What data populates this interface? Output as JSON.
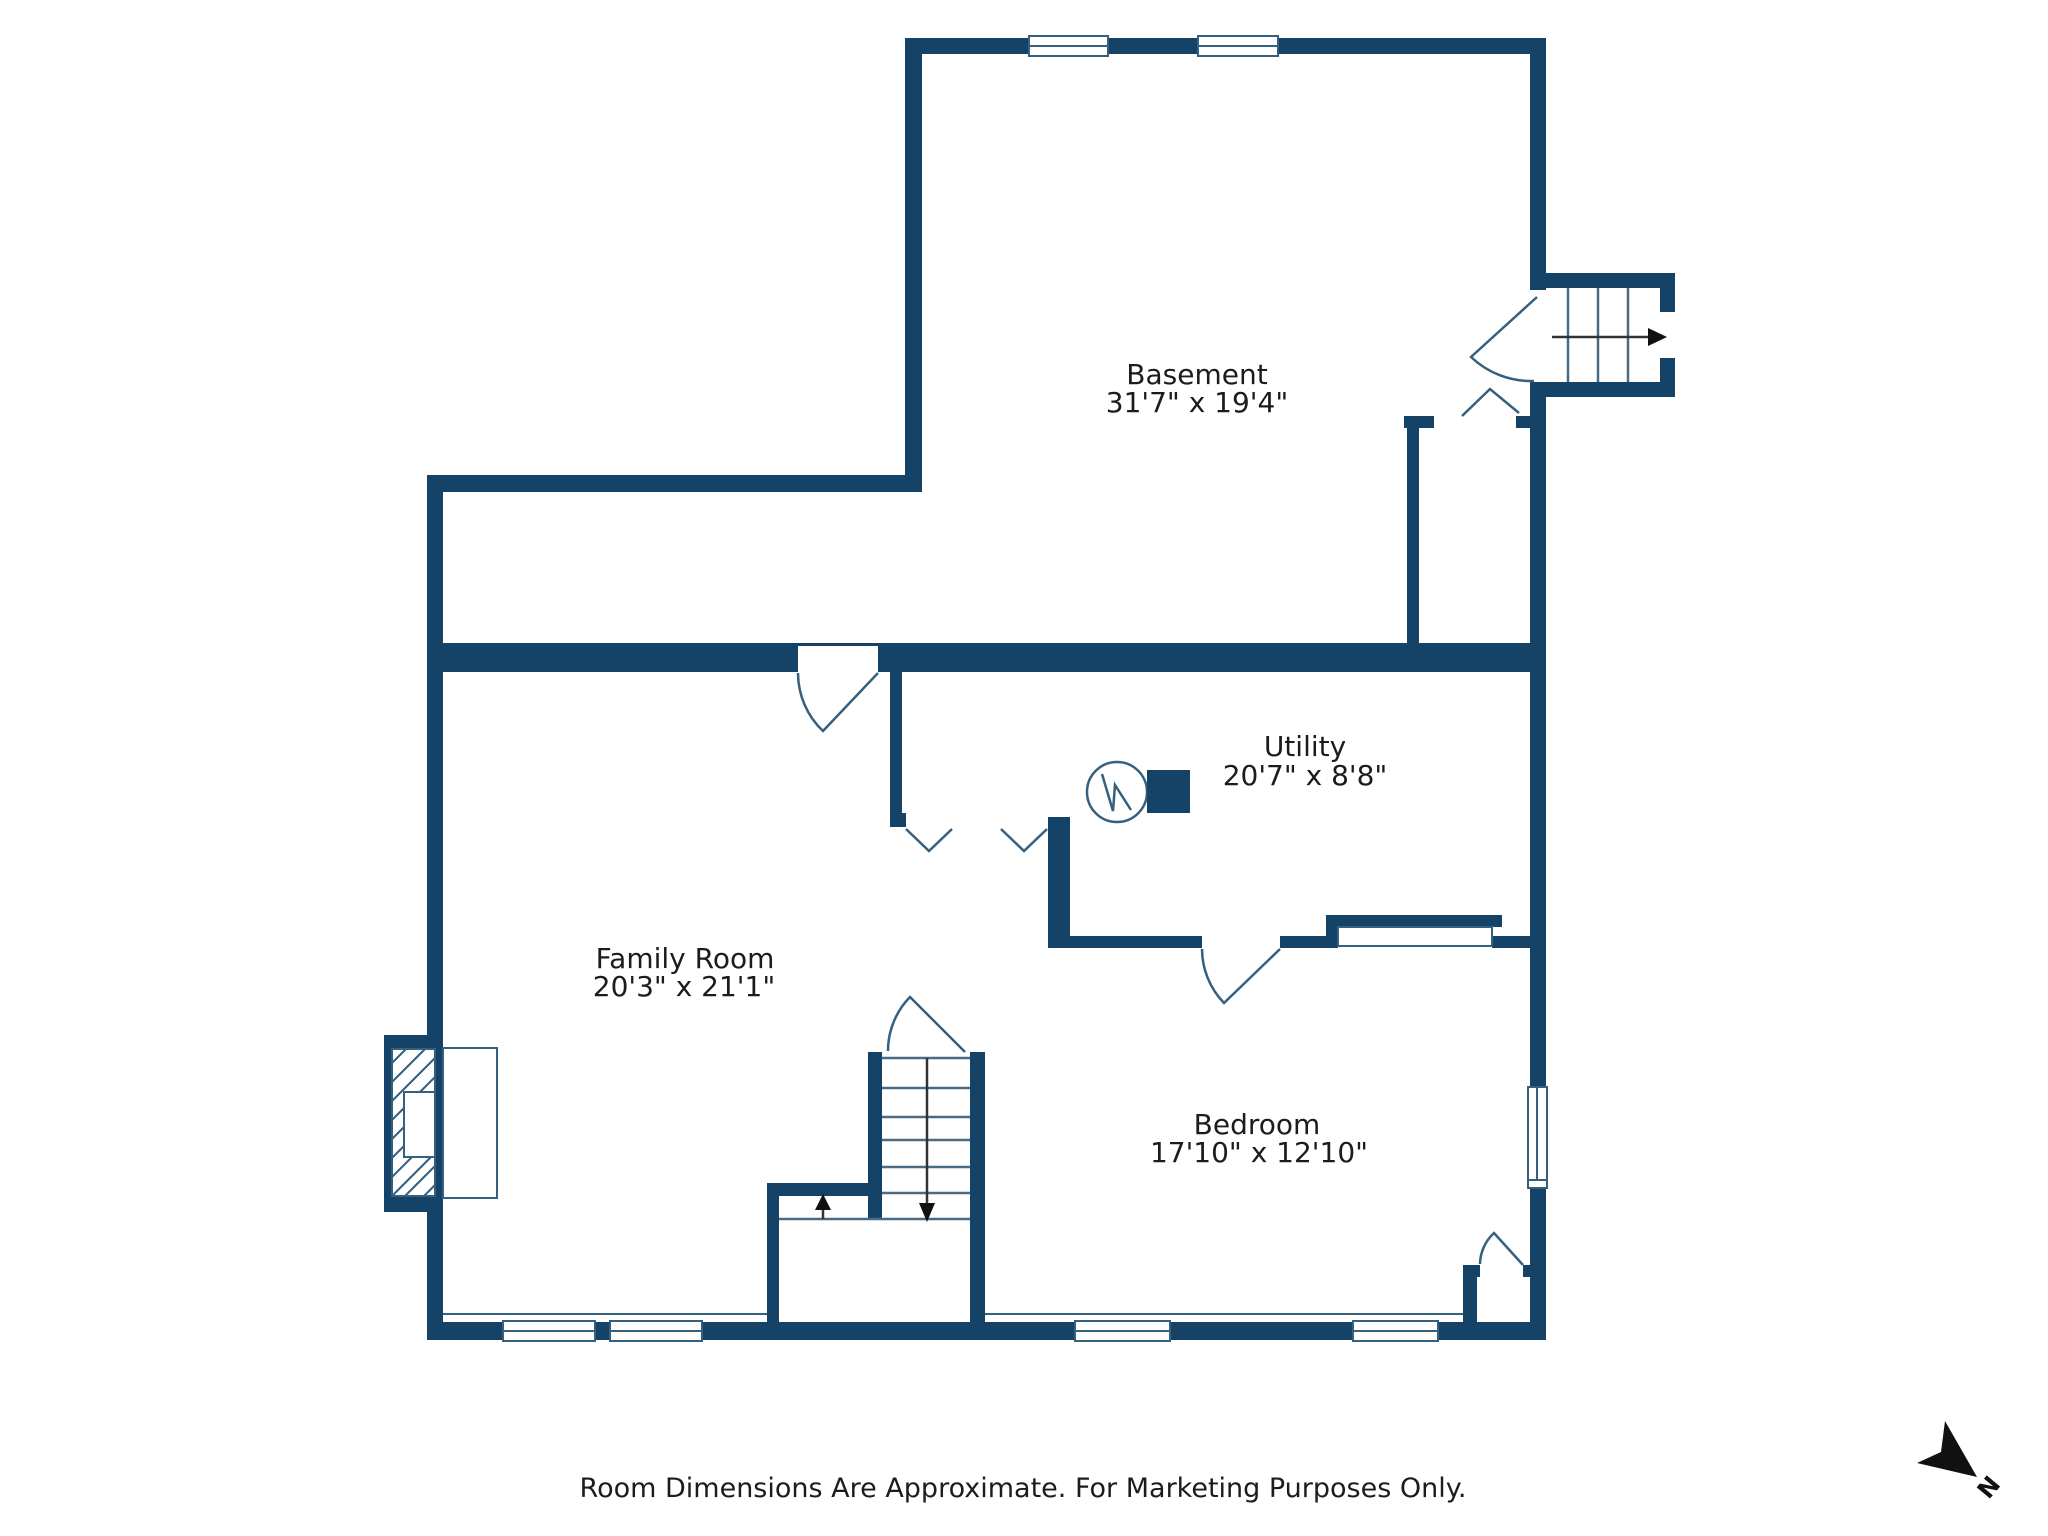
{
  "plan": {
    "rooms": [
      {
        "name": "Basement",
        "dims": "31'7\" x 19'4\""
      },
      {
        "name": "Utility",
        "dims": "20'7\" x 8'8\""
      },
      {
        "name": "Family Room",
        "dims": "20'3\" x 21'1\""
      },
      {
        "name": "Bedroom",
        "dims": "17'10\" x 12'10\""
      }
    ],
    "footer": "Room Dimensions Are Approximate. For Marketing Purposes Only.",
    "compass_label": "N",
    "colors": {
      "wall": "#154368",
      "detail_line": "#35607e",
      "text": "#1c1c1c",
      "background": "#ffffff"
    }
  }
}
